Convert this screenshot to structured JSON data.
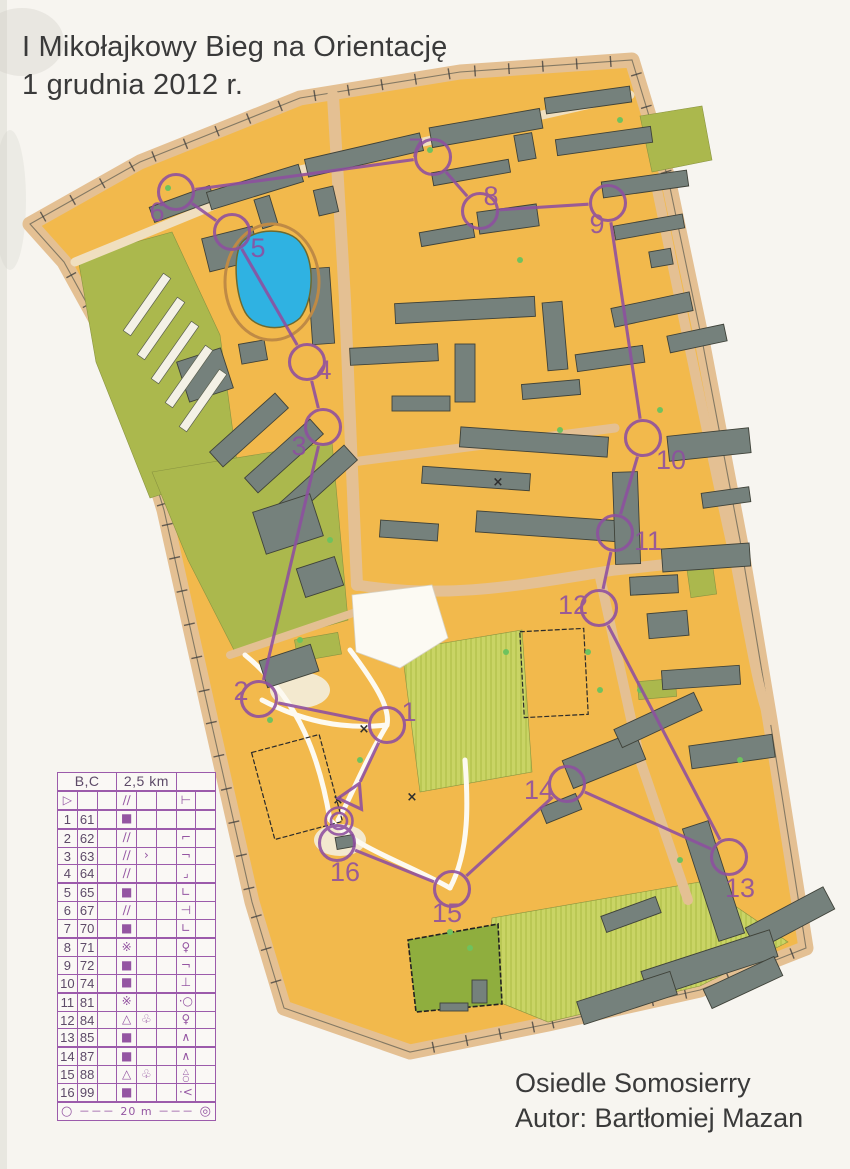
{
  "page": {
    "title_line1": "I Mikołajkowy Bieg na Orientację",
    "title_line2": "1 grudnia 2012 r."
  },
  "credits": {
    "line1": "Osiedle Somosierry",
    "line2": "Autor: Bartłomiej Mazan"
  },
  "colors": {
    "course_purple": "#8e4fa0",
    "sheet_purple": "#9c5bab",
    "urban_orange": "#f2b94c",
    "olive_green": "#abb84d",
    "light_green": "#c9d465",
    "dark_green": "#8fae3e",
    "building_gray": "#75817c",
    "road_tan": "#e4c093",
    "pond_blue": "#2fb2e2",
    "paper": "#f7f5f0",
    "text_dark": "#3a3a3a"
  },
  "control_card": {
    "header": {
      "course": "B,C",
      "length": "2,5 km",
      "climb": ""
    },
    "rows": [
      [
        "▷",
        "",
        "",
        "∕∕",
        "",
        "",
        "",
        ""
      ],
      [
        "1",
        "61",
        "",
        "■",
        "",
        "",
        "",
        ""
      ],
      [
        "2",
        "62",
        "",
        "∕∕",
        "",
        "",
        "⌐",
        ""
      ],
      [
        "3",
        "63",
        "",
        "∕∕",
        "›",
        "",
        "¬",
        ""
      ],
      [
        "4",
        "64",
        "",
        "∕∕",
        "",
        "",
        "⌟",
        ""
      ],
      [
        "5",
        "65",
        "",
        "■",
        "",
        "",
        "∟",
        ""
      ],
      [
        "6",
        "67",
        "",
        "∕∕",
        "",
        "",
        "⊣",
        ""
      ],
      [
        "7",
        "70",
        "",
        "■",
        "",
        "",
        "∟",
        ""
      ],
      [
        "8",
        "71",
        "",
        "※",
        "",
        "",
        "♀",
        ""
      ],
      [
        "9",
        "72",
        "",
        "■",
        "",
        "",
        "¬",
        ""
      ],
      [
        "10",
        "74",
        "",
        "■",
        "",
        "",
        "⊥",
        ""
      ],
      [
        "11",
        "81",
        "",
        "※",
        "",
        "",
        "·○",
        ""
      ],
      [
        "12",
        "84",
        "",
        "△",
        "♧",
        "",
        "♀",
        ""
      ],
      [
        "13",
        "85",
        "",
        "■",
        "",
        "",
        "∧",
        ""
      ],
      [
        "14",
        "87",
        "",
        "■",
        "",
        "",
        "∧",
        ""
      ],
      [
        "15",
        "88",
        "",
        "△",
        "♧",
        "",
        "△\n○",
        ""
      ],
      [
        "16",
        "99",
        "",
        "■",
        "",
        "",
        "·<",
        ""
      ]
    ],
    "start_row_g": "⊢",
    "footer": {
      "left": "○",
      "dashes1": "－－－",
      "label": "20 m",
      "dashes2": "－－－",
      "right": "◎"
    }
  },
  "course": {
    "start": {
      "x": 353,
      "y": 797
    },
    "finish": {
      "x": 339,
      "y": 821
    },
    "controls": [
      {
        "num": "1",
        "x": 387,
        "y": 725,
        "lx": 409,
        "ly": 712
      },
      {
        "num": "2",
        "x": 259,
        "y": 699,
        "lx": 241,
        "ly": 691
      },
      {
        "num": "3",
        "x": 323,
        "y": 427,
        "lx": 299,
        "ly": 446
      },
      {
        "num": "4",
        "x": 307,
        "y": 362,
        "lx": 324,
        "ly": 370
      },
      {
        "num": "5",
        "x": 232,
        "y": 232,
        "lx": 258,
        "ly": 248
      },
      {
        "num": "6",
        "x": 176,
        "y": 192,
        "lx": 157,
        "ly": 212
      },
      {
        "num": "7",
        "x": 433,
        "y": 157,
        "lx": 416,
        "ly": 148
      },
      {
        "num": "8",
        "x": 480,
        "y": 211,
        "lx": 491,
        "ly": 196
      },
      {
        "num": "9",
        "x": 608,
        "y": 203,
        "lx": 597,
        "ly": 224
      },
      {
        "num": "10",
        "x": 643,
        "y": 438,
        "lx": 671,
        "ly": 460
      },
      {
        "num": "11",
        "x": 615,
        "y": 533,
        "lx": 648,
        "ly": 541
      },
      {
        "num": "12",
        "x": 599,
        "y": 608,
        "lx": 573,
        "ly": 605
      },
      {
        "num": "13",
        "x": 729,
        "y": 857,
        "lx": 740,
        "ly": 888
      },
      {
        "num": "14",
        "x": 567,
        "y": 784,
        "lx": 539,
        "ly": 790
      },
      {
        "num": "15",
        "x": 452,
        "y": 889,
        "lx": 447,
        "ly": 913
      },
      {
        "num": "16",
        "x": 337,
        "y": 843,
        "lx": 345,
        "ly": 872
      }
    ]
  }
}
